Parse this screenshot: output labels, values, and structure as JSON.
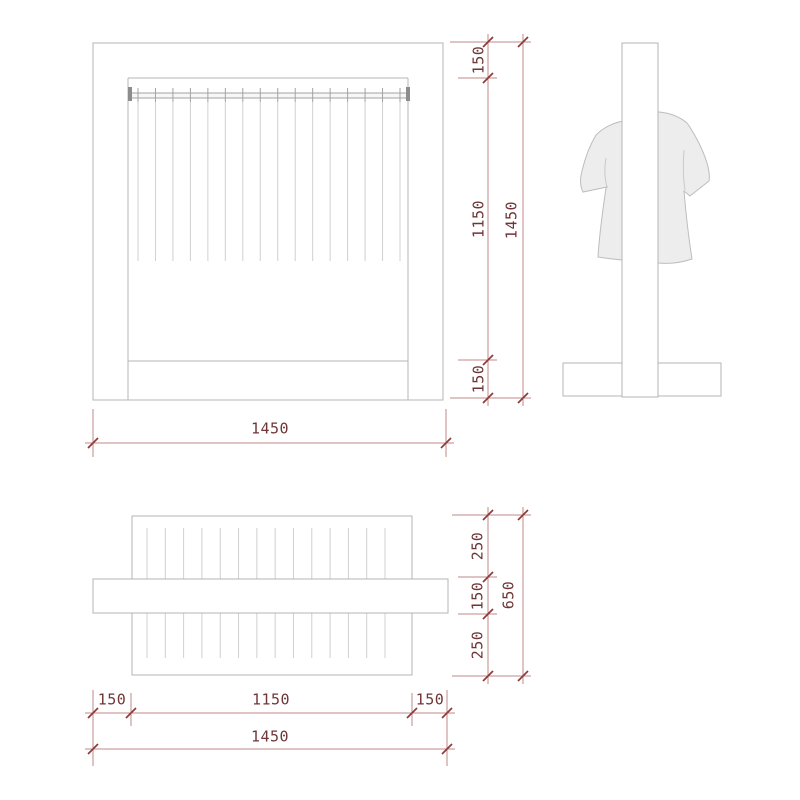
{
  "drawing": {
    "views": {
      "front": {
        "hanger_count": 16
      },
      "plan": {
        "hanger_count": 14
      }
    }
  },
  "colors": {
    "dimension_line": "#c18a8a",
    "dimension_tick": "#8d3a3a",
    "dimension_text": "#6e3636",
    "outline_gray": "#b5b5b5",
    "outline_light_gray": "#d0d0d0",
    "shirt_fill": "#ededed",
    "background": "#ffffff"
  },
  "dimensions": {
    "front_height": {
      "segment_top": "150",
      "segment_middle": "1150",
      "segment_bottom": "150",
      "overall": "1450"
    },
    "front_width": {
      "overall": "1450"
    },
    "plan_depth": {
      "segment_top": "250",
      "segment_middle": "150",
      "segment_bottom": "250",
      "overall": "650"
    },
    "plan_width": {
      "segment_left": "150",
      "segment_middle": "1150",
      "segment_right": "150",
      "overall": "1450"
    }
  }
}
